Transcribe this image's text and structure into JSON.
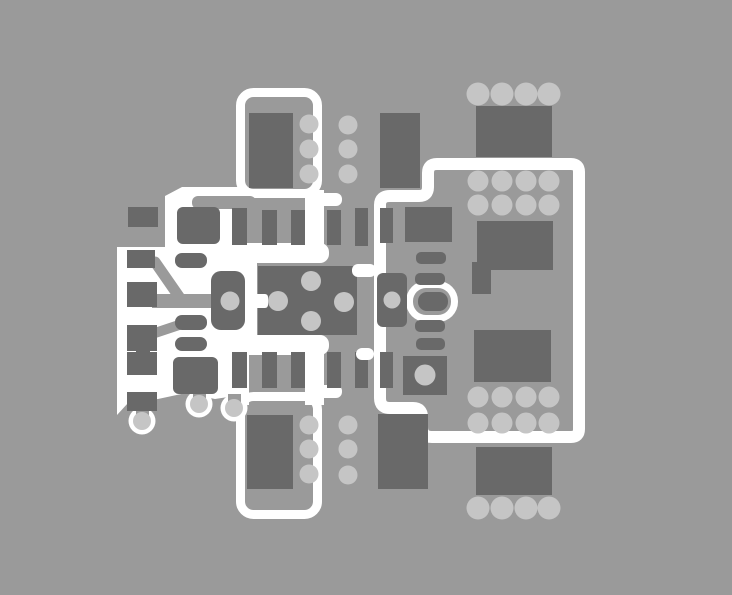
{
  "title": "PCB copper layer layout view",
  "canvas": {
    "width": 732,
    "height": 595
  },
  "colors": {
    "background": "#9a9a9a",
    "pad_dark": "#696969",
    "via_light": "#c5c5c5",
    "silkscreen_white": "#ffffff",
    "trace_gray": "#9a9a9a"
  },
  "layers": {
    "silkscreen": "white component outlines and copper pour",
    "traces": "board-gray routed traces",
    "pads": "dark gray copper pads",
    "vias": "light gray plated holes"
  },
  "inventory": {
    "component_outline_top": {
      "ic_body_pads": 1,
      "via_columns": 2,
      "vias_per_column": 3
    },
    "component_outline_bottom": {
      "ic_body_pads": 1,
      "via_columns": 2,
      "vias_per_column": 3
    },
    "right_module_box": {
      "via_grid_rows": 4,
      "via_grid_cols": 4,
      "large_pads": 4,
      "side_pin_bars": 4,
      "obround_pads": 1
    },
    "center_ic": {
      "top_pins": 6,
      "bottom_pins": 6,
      "thermal_vias": 4
    },
    "left_connector_pour": {
      "edge_pads": 5,
      "inner_pads": 5,
      "teardrop_holes": 3
    },
    "top_via_row": 4,
    "bottom_via_row": 4
  }
}
